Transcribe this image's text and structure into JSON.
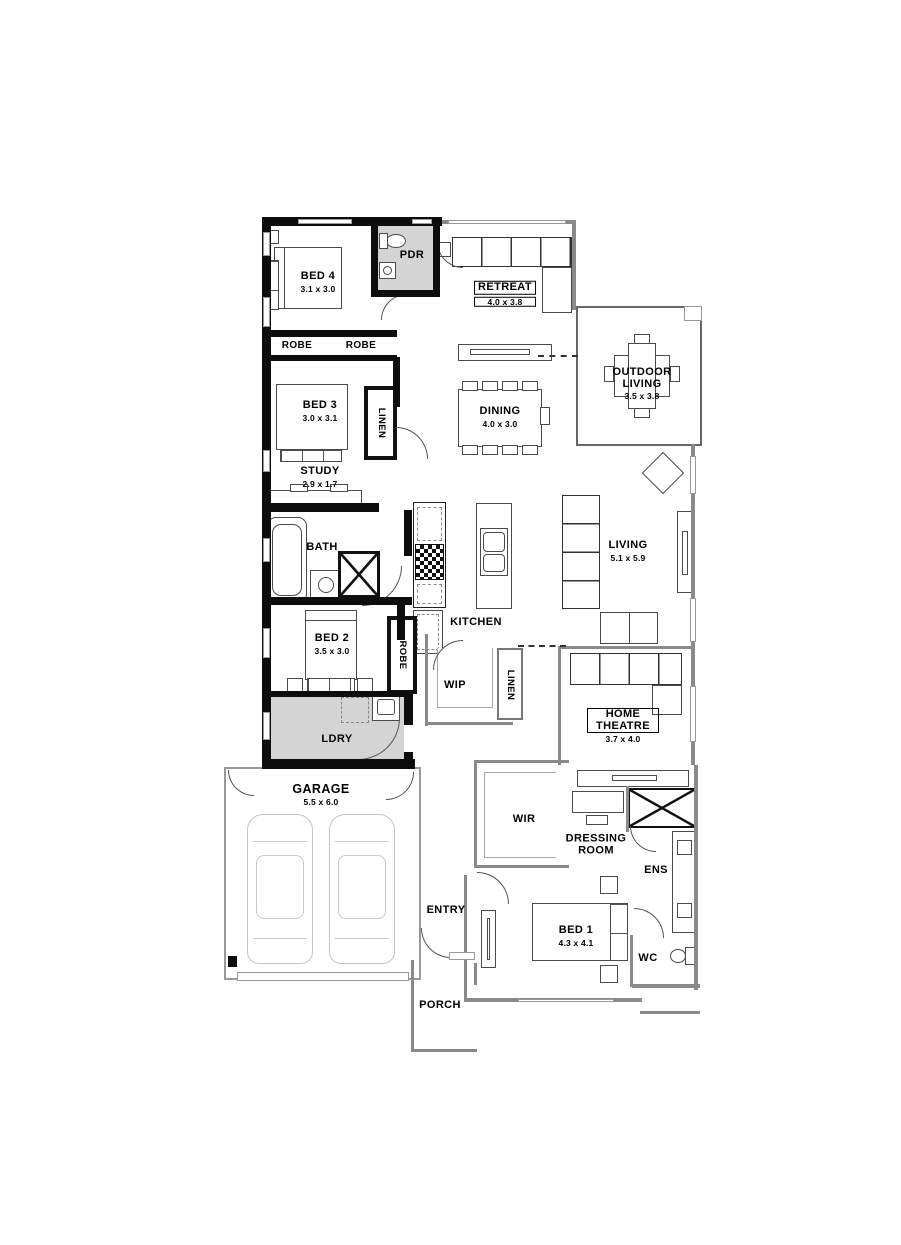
{
  "title": "Single storey house floor plan",
  "colors": {
    "masonry_wall": "#0d0d0d",
    "stud_wall": "#8a8a8a",
    "shaded_room": "#d4d4d4",
    "background": "#ffffff",
    "text": "#000000"
  },
  "rooms": {
    "bed4": {
      "label": "BED 4",
      "dims": "3.1 x 3.0"
    },
    "pdr": {
      "label": "PDR"
    },
    "retreat": {
      "label": "RETREAT",
      "dims": "4.0 x 3.8"
    },
    "outdoor": {
      "label": "OUTDOOR LIVING",
      "dims": "3.5 x 3.8"
    },
    "robe_a": {
      "label": "ROBE"
    },
    "robe_b": {
      "label": "ROBE"
    },
    "bed3": {
      "label": "BED 3",
      "dims": "3.0 x 3.1"
    },
    "linen_a": {
      "label": "LINEN"
    },
    "dining": {
      "label": "DINING",
      "dims": "4.0 x 3.0"
    },
    "study": {
      "label": "STUDY",
      "dims": "2.9 x 1.7"
    },
    "bath": {
      "label": "BATH"
    },
    "kitchen": {
      "label": "KITCHEN"
    },
    "living": {
      "label": "LIVING",
      "dims": "5.1 x 5.9"
    },
    "bed2": {
      "label": "BED 2",
      "dims": "3.5 x 3.0"
    },
    "robe_c": {
      "label": "ROBE"
    },
    "wip": {
      "label": "WIP"
    },
    "linen_b": {
      "label": "LINEN"
    },
    "home_theatre": {
      "label": "HOME THEATRE",
      "dims": "3.7 x 4.0"
    },
    "ldry": {
      "label": "LDRY"
    },
    "garage": {
      "label": "GARAGE",
      "dims": "5.5 x 6.0"
    },
    "wir": {
      "label": "WIR"
    },
    "dressing": {
      "label": "DRESSING ROOM"
    },
    "ens": {
      "label": "ENS"
    },
    "entry": {
      "label": "ENTRY"
    },
    "bed1": {
      "label": "BED 1",
      "dims": "4.3 x 4.1"
    },
    "wc": {
      "label": "WC"
    },
    "porch": {
      "label": "PORCH"
    }
  }
}
